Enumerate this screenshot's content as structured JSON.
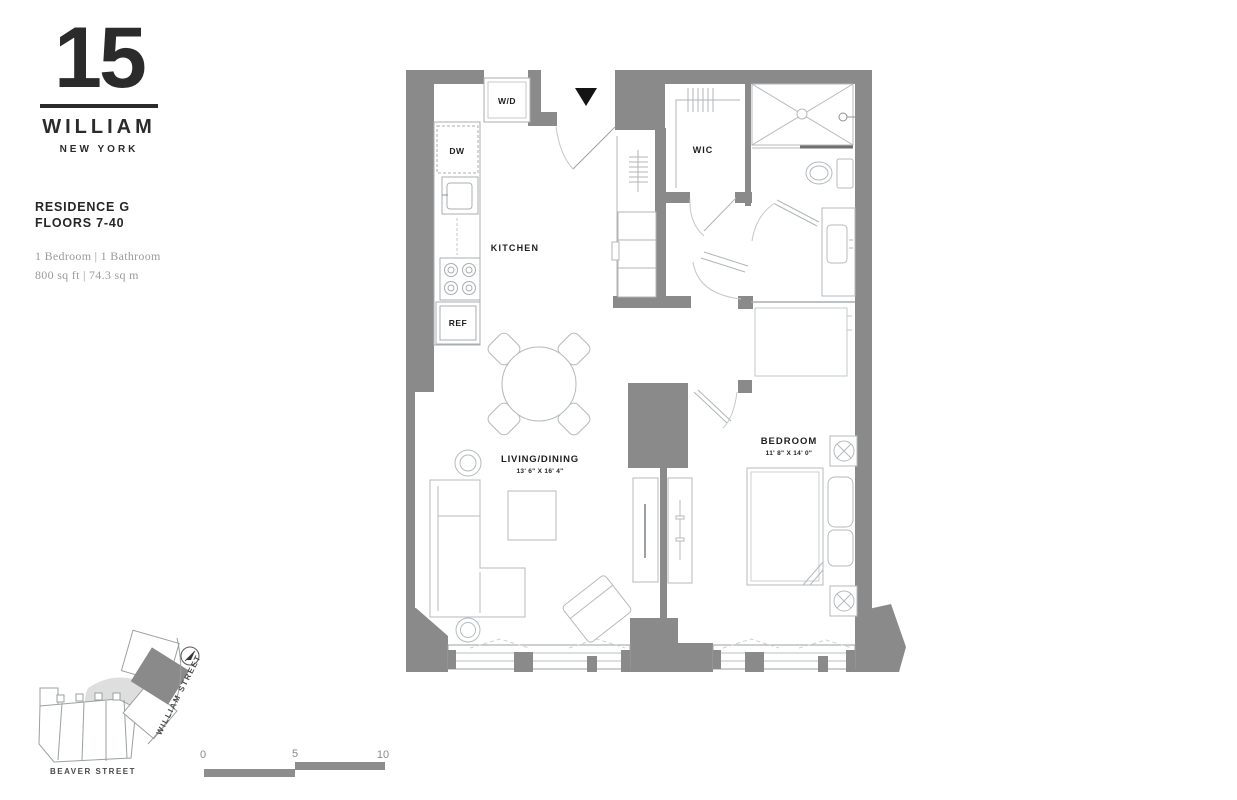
{
  "brand": {
    "number": "15",
    "name": "WILLIAM",
    "city": "NEW YORK"
  },
  "residence": {
    "title": "RESIDENCE G",
    "floors": "FLOORS 7-40",
    "config": "1 Bedroom | 1 Bathroom",
    "area": "800 sq ft | 74.3 sq m"
  },
  "plan": {
    "labels": {
      "washer_dryer": "W/D",
      "dishwasher": "DW",
      "refrigerator": "REF",
      "kitchen": "KITCHEN",
      "walk_in_closet": "WIC",
      "living_dining": "LIVING/DINING",
      "living_dining_dims": "13' 6\" X 16' 4\"",
      "bedroom": "BEDROOM",
      "bedroom_dims": "11' 8\" X 14' 0\""
    }
  },
  "site_map": {
    "street_1": "WILLIAM STREET",
    "street_2": "BEAVER STREET"
  },
  "scale_bar": {
    "start": "0",
    "mid": "5",
    "end": "10"
  },
  "colors": {
    "wall": "#8a8a8a",
    "furniture_line": "#b4babd",
    "text_dark": "#1e1e1e",
    "text_muted": "#9b9b9b",
    "site_fill": "#dedede"
  }
}
